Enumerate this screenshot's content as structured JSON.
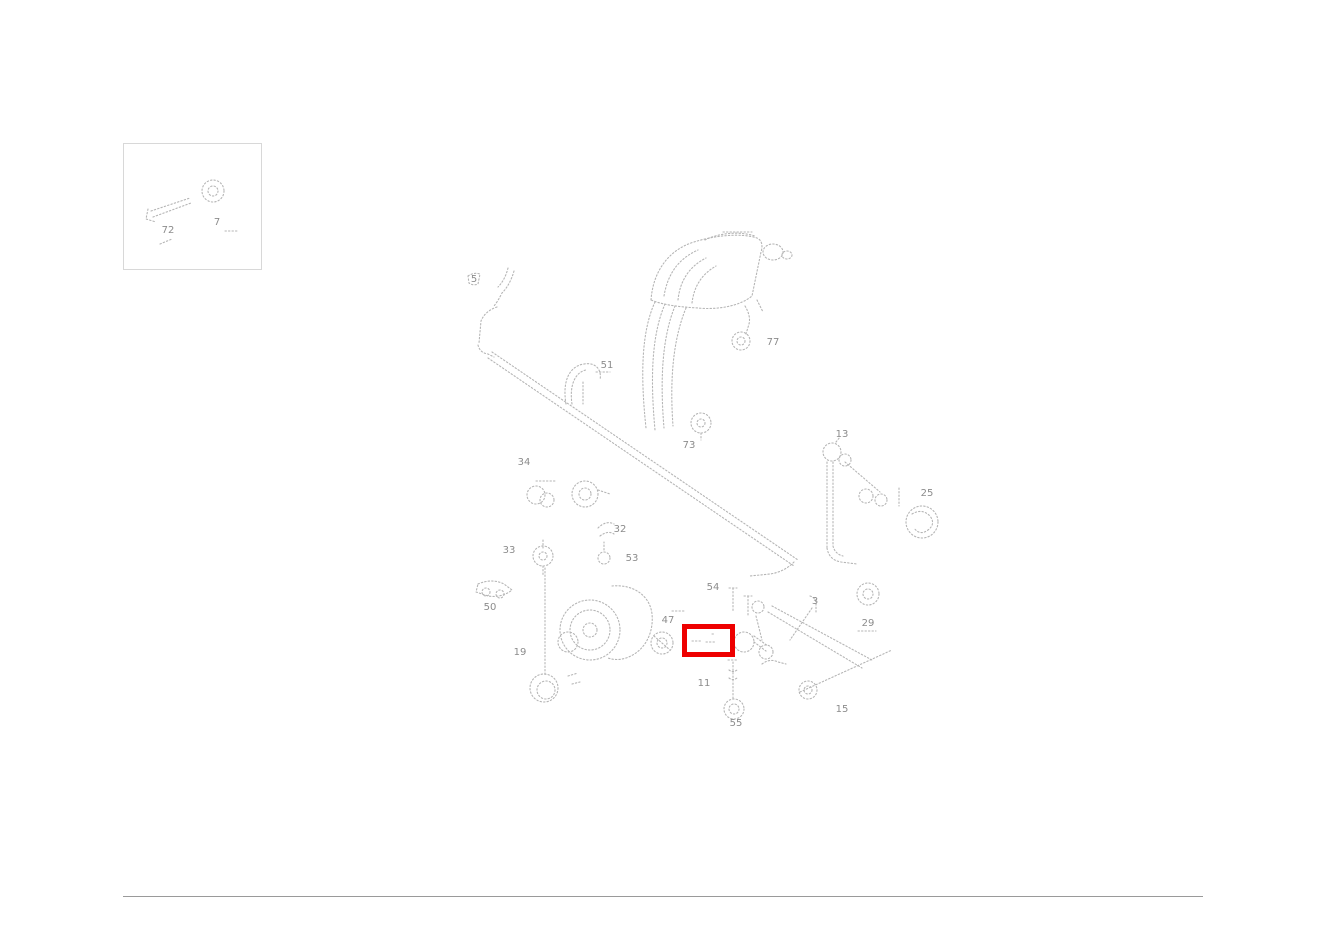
{
  "canvas": {
    "width": 1326,
    "height": 937,
    "background": "#ffffff"
  },
  "artwork": {
    "stroke_color": "#b5b5b5",
    "label_color": "#8c8c8c"
  },
  "inset": {
    "x": 123,
    "y": 143,
    "width": 137,
    "height": 125,
    "border_color": "#d8d8d8"
  },
  "inset_labels": [
    {
      "text": "72",
      "x": 168,
      "y": 233
    },
    {
      "text": "7",
      "x": 217,
      "y": 225
    }
  ],
  "part_labels": [
    {
      "text": "5",
      "x": 474,
      "y": 282
    },
    {
      "text": "51",
      "x": 607,
      "y": 368
    },
    {
      "text": "77",
      "x": 773,
      "y": 345
    },
    {
      "text": "73",
      "x": 689,
      "y": 448
    },
    {
      "text": "13",
      "x": 842,
      "y": 437
    },
    {
      "text": "25",
      "x": 927,
      "y": 496
    },
    {
      "text": "34",
      "x": 524,
      "y": 465
    },
    {
      "text": "32",
      "x": 620,
      "y": 532
    },
    {
      "text": "53",
      "x": 632,
      "y": 561
    },
    {
      "text": "33",
      "x": 509,
      "y": 553
    },
    {
      "text": "50",
      "x": 490,
      "y": 610
    },
    {
      "text": "19",
      "x": 520,
      "y": 655
    },
    {
      "text": "47",
      "x": 668,
      "y": 623
    },
    {
      "text": "54",
      "x": 713,
      "y": 590
    },
    {
      "text": "3",
      "x": 815,
      "y": 604
    },
    {
      "text": "29",
      "x": 868,
      "y": 626
    },
    {
      "text": "11",
      "x": 704,
      "y": 686
    },
    {
      "text": "55",
      "x": 736,
      "y": 726
    },
    {
      "text": "15",
      "x": 842,
      "y": 712
    }
  ],
  "highlight": {
    "x": 682,
    "y": 624,
    "width": 53,
    "height": 33,
    "border_color": "#ee0000",
    "border_width": 5
  },
  "footer": {
    "x": 123,
    "y": 896,
    "width": 1080,
    "color": "#9a9a9a"
  }
}
